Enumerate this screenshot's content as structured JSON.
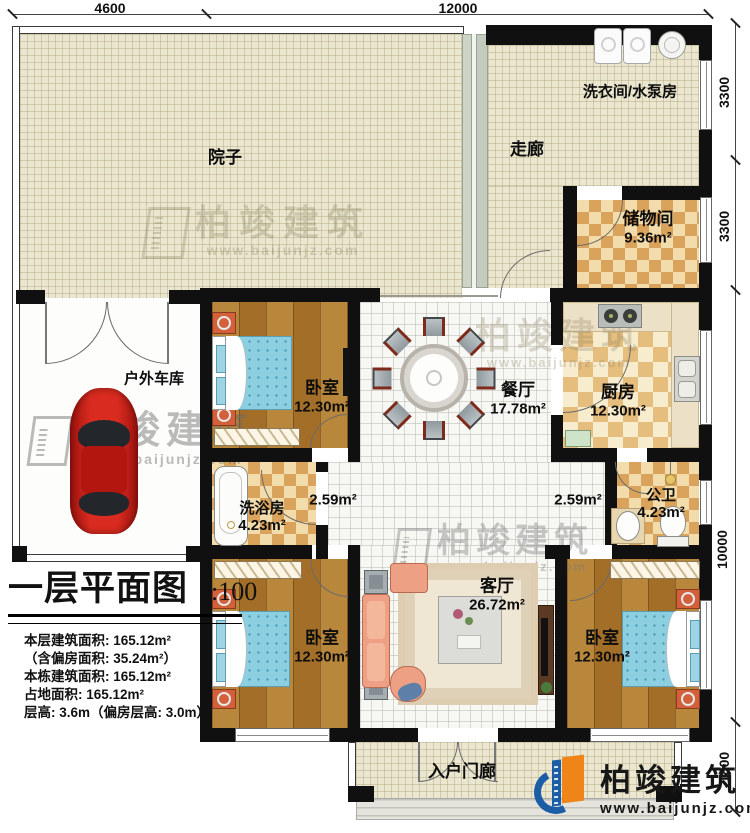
{
  "plan": {
    "title_block": {
      "title": "一层平面图",
      "scale": "1:100",
      "lines": [
        "本层建筑面积: 165.12m²",
        "（含偏房面积: 35.24m²）",
        "本栋建筑面积: 165.12m²",
        "占地面积: 165.12m²",
        "层高: 3.6m（偏房层高: 3.0m）"
      ]
    },
    "dimensions": {
      "top": [
        "4600",
        "12000"
      ],
      "right": [
        "3300",
        "3300",
        "10000",
        "1800"
      ]
    },
    "rooms": {
      "yard": {
        "name": "院子"
      },
      "corridor": {
        "name": "走廊"
      },
      "laundry": {
        "name": "洗衣间/水泵房"
      },
      "storage": {
        "name": "储物间",
        "area": "9.36m²"
      },
      "garage": {
        "name": "户外车库"
      },
      "bedroom_top": {
        "name": "卧室",
        "area": "12.30m²"
      },
      "dining": {
        "name": "餐厅",
        "area": "17.78m²"
      },
      "kitchen": {
        "name": "厨房",
        "area": "12.30m²"
      },
      "bath": {
        "name": "洗浴房",
        "area": "4.23m²"
      },
      "hall_left": {
        "area": "2.59m²"
      },
      "hall_right": {
        "area": "2.59m²"
      },
      "wc": {
        "name": "公卫",
        "area": "4.23m²"
      },
      "bedroom_left": {
        "name": "卧室",
        "area": "12.30m²"
      },
      "living": {
        "name": "客厅",
        "area": "26.72m²"
      },
      "bedroom_right": {
        "name": "卧室",
        "area": "12.30m²"
      },
      "porch": {
        "name": "入户门廊"
      }
    },
    "watermark": {
      "brand": "柏竣建筑",
      "url": "www.baijunjz.com"
    },
    "logo": {
      "brand": "柏竣建筑",
      "url": "www.baijunjz.com"
    },
    "colors": {
      "wall": "#101010",
      "floor_grid": "#eae6d0",
      "floor_wood": "#ad7a31",
      "floor_checker": "#dca75f",
      "bed": "#8ccfe1",
      "car": "#c3201b",
      "sofa": "#eda083",
      "logo_blue": "#1b5ea6",
      "logo_orange": "#ef8418"
    }
  }
}
